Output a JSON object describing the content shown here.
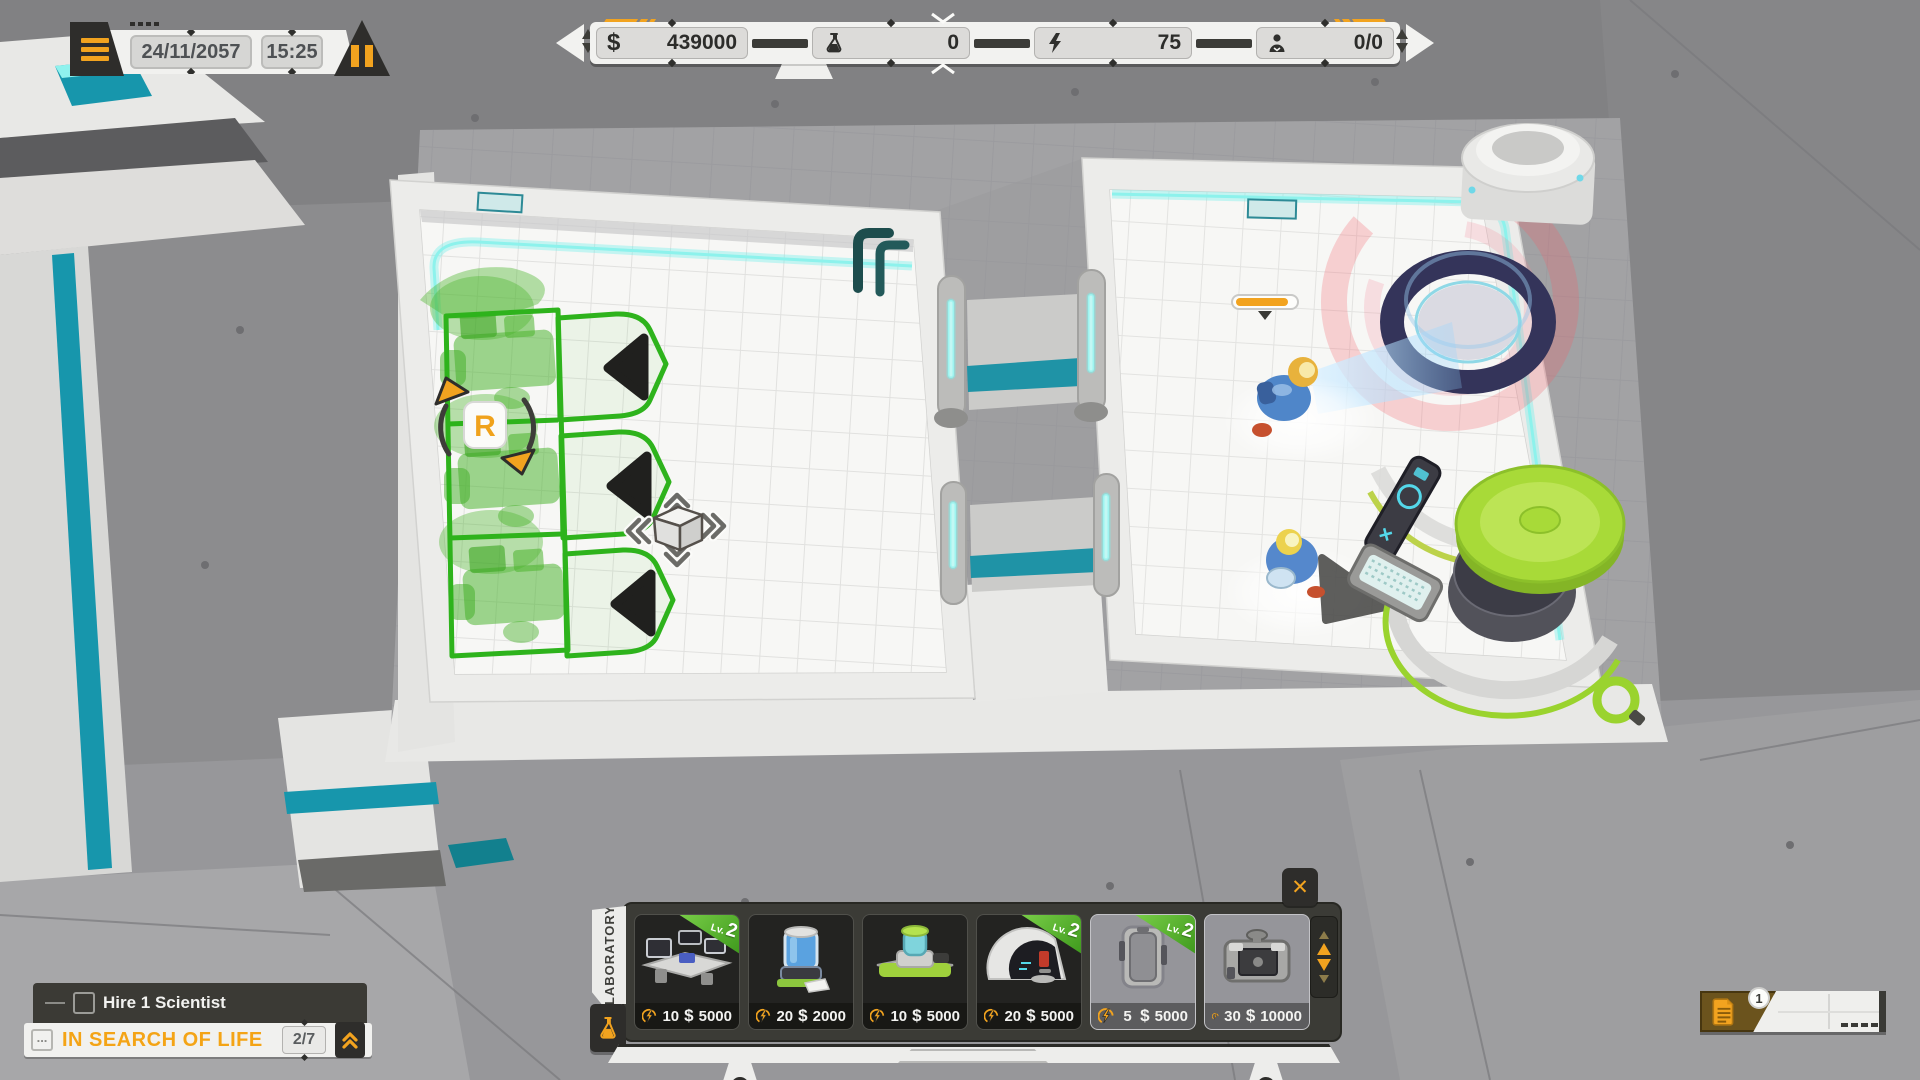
{
  "hud": {
    "clock": {
      "date": "24/11/2057",
      "time": "15:25"
    },
    "resources": {
      "money": {
        "symbol": "$",
        "value": "439000"
      },
      "science": {
        "value": "0"
      },
      "energy": {
        "value": "75"
      },
      "staff": {
        "value": "0/0"
      }
    },
    "build_menu": {
      "category": "LABORATORY",
      "close_label": "✕",
      "currency": "$",
      "lv_label": "Lv.",
      "items": [
        {
          "name": "research workstation",
          "level": "2",
          "energy_cost": "10",
          "price": "5000"
        },
        {
          "name": "sample tank",
          "level": "",
          "energy_cost": "20",
          "price": "2000"
        },
        {
          "name": "bio analyzer",
          "level": "",
          "energy_cost": "10",
          "price": "5000"
        },
        {
          "name": "observation dome",
          "level": "2",
          "energy_cost": "20",
          "price": "5000"
        },
        {
          "name": "storage locker",
          "level": "2",
          "energy_cost": "5",
          "price": "5000"
        },
        {
          "name": "generator",
          "level": "",
          "energy_cost": "30",
          "price": "10000"
        }
      ]
    },
    "quest": {
      "objective": "Hire 1 Scientist",
      "title": "IN SEARCH OF LIFE",
      "progress": "2/7",
      "more_icon": "..."
    },
    "notifications": {
      "count": "1"
    }
  },
  "world": {
    "placement": {
      "rotate_key": "R"
    }
  }
}
